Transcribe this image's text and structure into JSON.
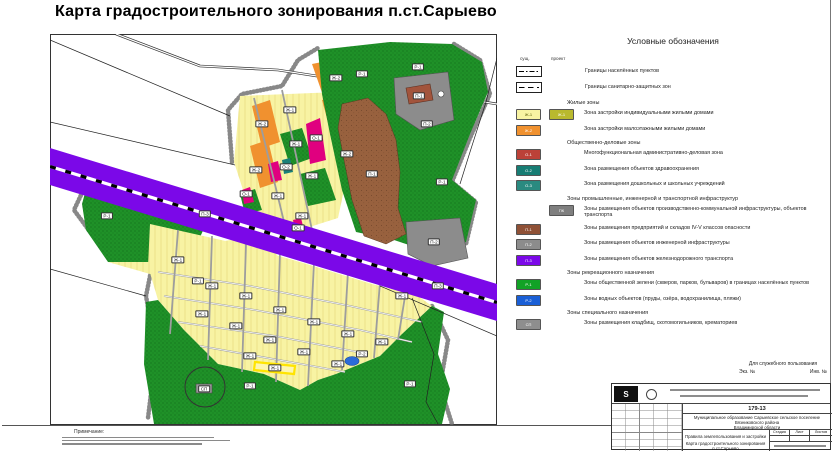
{
  "sheet": {
    "title": "Карта градостроительного зонирования п.ст.Сарыево"
  },
  "legend": {
    "title": "Условные обозначения",
    "col_existing": "сущ.",
    "col_project": "проект",
    "boundaries": [
      {
        "label": "Границы населённых пунктов"
      },
      {
        "label": "Границы санитарно-защитных зон"
      }
    ],
    "sections": [
      {
        "heading": "Жилые зоны",
        "rows": [
          {
            "code": "Ж-1",
            "color": "#f8f3a3",
            "code2": "Ж-1",
            "color2": "#b9b92e",
            "label": "Зона застройки индивидуальными жилыми домами"
          },
          {
            "code": "Ж-2",
            "color": "#f0912f",
            "label": "Зона застройки малоэтажными жилыми домами"
          }
        ]
      },
      {
        "heading": "Общественно-деловые зоны",
        "rows": [
          {
            "code": "О-1",
            "color": "#bc4138",
            "label": "Многофункциональная административно-деловая зона"
          },
          {
            "code": "О-2",
            "color": "#177d74",
            "label": "Зона размещения объектов здравоохранения"
          },
          {
            "code": "О-3",
            "color": "#2a8a80",
            "label": "Зона размещения дошкольных и школьных учреждений"
          }
        ]
      },
      {
        "heading": "Зоны промышленные, инженерной и транспортной инфраструктур",
        "rows": [
          {
            "code": "ПК",
            "color": "#7f7f7f",
            "column": "проект",
            "label": "Зоны размещения объектов производственно-коммунальной инфраструктуры, объектов транспорта"
          },
          {
            "code": "П-1",
            "color": "#8f5136",
            "label": "Зоны размещения предприятий и складов IV-V классов опасности"
          },
          {
            "code": "П-2",
            "color": "#8c8c8c",
            "label": "Зоны размещения объектов инженерной инфраструктуры"
          },
          {
            "code": "П-3",
            "color": "#7b08e8",
            "label": "Зоны размещения объектов железнодорожного транспорта"
          }
        ]
      },
      {
        "heading": "Зоны рекреационного назначения",
        "rows": [
          {
            "code": "Р-1",
            "color": "#12a226",
            "label": "Зоны общественной зелени (скверов, парков, бульваров) в границах населённых пунктов"
          },
          {
            "code": "Р-2",
            "color": "#1a5fd6",
            "label": "Зоны водных объектов (пруды, озёра, водохранилища, пляжи)"
          }
        ]
      },
      {
        "heading": "Зоны специального назначения",
        "rows": [
          {
            "code": "СП",
            "color": "#8e8e8e",
            "label": "Зоны размещения кладбищ, скотомогильников, крематориев"
          }
        ]
      }
    ]
  },
  "map": {
    "zone_colors": {
      "zh1": "#f8f3a3",
      "zh2": "#f0912f",
      "o1map": "#e0007f",
      "o2": "#1a8078",
      "pk": "#8c8c8c",
      "p1": "#98613e",
      "p3": "#7b08e8",
      "r1": "#1f9128",
      "r2": "#2b6bd8",
      "sp": "#9a9a9a",
      "road": "#9d9d9d",
      "highlight": "#ffe400"
    },
    "labels": [
      {
        "code": "П-3",
        "x": 155,
        "y": 180
      },
      {
        "code": "П-3",
        "x": 388,
        "y": 252
      },
      {
        "code": "Р-1",
        "x": 57,
        "y": 182
      },
      {
        "code": "Ж-1",
        "x": 128,
        "y": 226
      },
      {
        "code": "Р-1",
        "x": 148,
        "y": 247
      },
      {
        "code": "Ж-2",
        "x": 212,
        "y": 90
      },
      {
        "code": "Ж-2",
        "x": 286,
        "y": 44
      },
      {
        "code": "Ж-2",
        "x": 297,
        "y": 120
      },
      {
        "code": "Ж-2",
        "x": 206,
        "y": 136
      },
      {
        "code": "Ж-1",
        "x": 240,
        "y": 76
      },
      {
        "code": "Ж-1",
        "x": 246,
        "y": 110
      },
      {
        "code": "Ж-1",
        "x": 262,
        "y": 142
      },
      {
        "code": "Ж-1",
        "x": 228,
        "y": 162
      },
      {
        "code": "Ж-1",
        "x": 252,
        "y": 182
      },
      {
        "code": "О-1",
        "x": 266,
        "y": 104
      },
      {
        "code": "О-1",
        "x": 196,
        "y": 160
      },
      {
        "code": "О-1",
        "x": 248,
        "y": 194
      },
      {
        "code": "О-2",
        "x": 236,
        "y": 133
      },
      {
        "code": "Р-1",
        "x": 312,
        "y": 40
      },
      {
        "code": "Р-1",
        "x": 368,
        "y": 33
      },
      {
        "code": "Р-1",
        "x": 392,
        "y": 148
      },
      {
        "code": "П-1",
        "x": 322,
        "y": 140
      },
      {
        "code": "П-1",
        "x": 369,
        "y": 62
      },
      {
        "code": "П-2",
        "x": 377,
        "y": 90
      },
      {
        "code": "П-2",
        "x": 384,
        "y": 208
      },
      {
        "code": "Ж-1",
        "x": 162,
        "y": 252
      },
      {
        "code": "Ж-1",
        "x": 196,
        "y": 262
      },
      {
        "code": "Ж-1",
        "x": 230,
        "y": 276
      },
      {
        "code": "Ж-1",
        "x": 264,
        "y": 288
      },
      {
        "code": "Ж-1",
        "x": 298,
        "y": 300
      },
      {
        "code": "Ж-1",
        "x": 332,
        "y": 308
      },
      {
        "code": "Ж-1",
        "x": 152,
        "y": 280
      },
      {
        "code": "Ж-1",
        "x": 186,
        "y": 292
      },
      {
        "code": "Ж-1",
        "x": 220,
        "y": 306
      },
      {
        "code": "Ж-1",
        "x": 254,
        "y": 318
      },
      {
        "code": "Ж-1",
        "x": 288,
        "y": 330
      },
      {
        "code": "Ж-1",
        "x": 200,
        "y": 322
      },
      {
        "code": "Ж-1",
        "x": 352,
        "y": 262
      },
      {
        "code": "Ж-1",
        "x": 225,
        "y": 334
      },
      {
        "code": "Р-1",
        "x": 200,
        "y": 352
      },
      {
        "code": "Р-1",
        "x": 360,
        "y": 350
      },
      {
        "code": "Р-2",
        "x": 312,
        "y": 320
      },
      {
        "code": "СП",
        "x": 154,
        "y": 355
      }
    ]
  },
  "notes": {
    "heading": "Примечание:"
  },
  "dsp": {
    "heading": "Для служебного пользования",
    "copy_label": "Экз. №",
    "inv_label": "Инв. №"
  },
  "stamp": {
    "doc_number": "179-13",
    "org_line1": "Муниципальное образование Сарыевское сельское поселение",
    "org_line2": "Вязниковского района",
    "org_line3": "Владимирской области",
    "doc_type": "Правила землепользования и застройки",
    "sheet_name": "Карта градостроительного зонирования п.ст.Сарыево",
    "col_stage": "Стадия",
    "col_sheet": "Лист",
    "col_sheets": "Листов"
  }
}
